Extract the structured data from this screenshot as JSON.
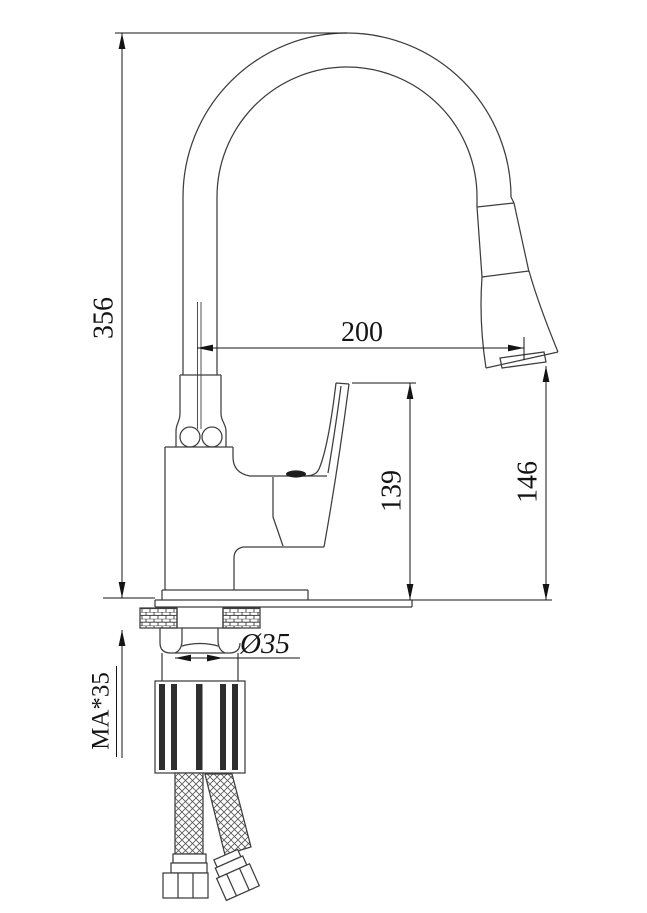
{
  "drawing": {
    "background": "#ffffff",
    "line_color": "#3d3d3d",
    "dimension_color": "#141414",
    "labels": {
      "overall_height": "356",
      "spout_reach": "200",
      "body_height": "139",
      "outlet_height": "146",
      "shank_diameter": "Ø35",
      "deck_thickness": "MA*35"
    }
  }
}
